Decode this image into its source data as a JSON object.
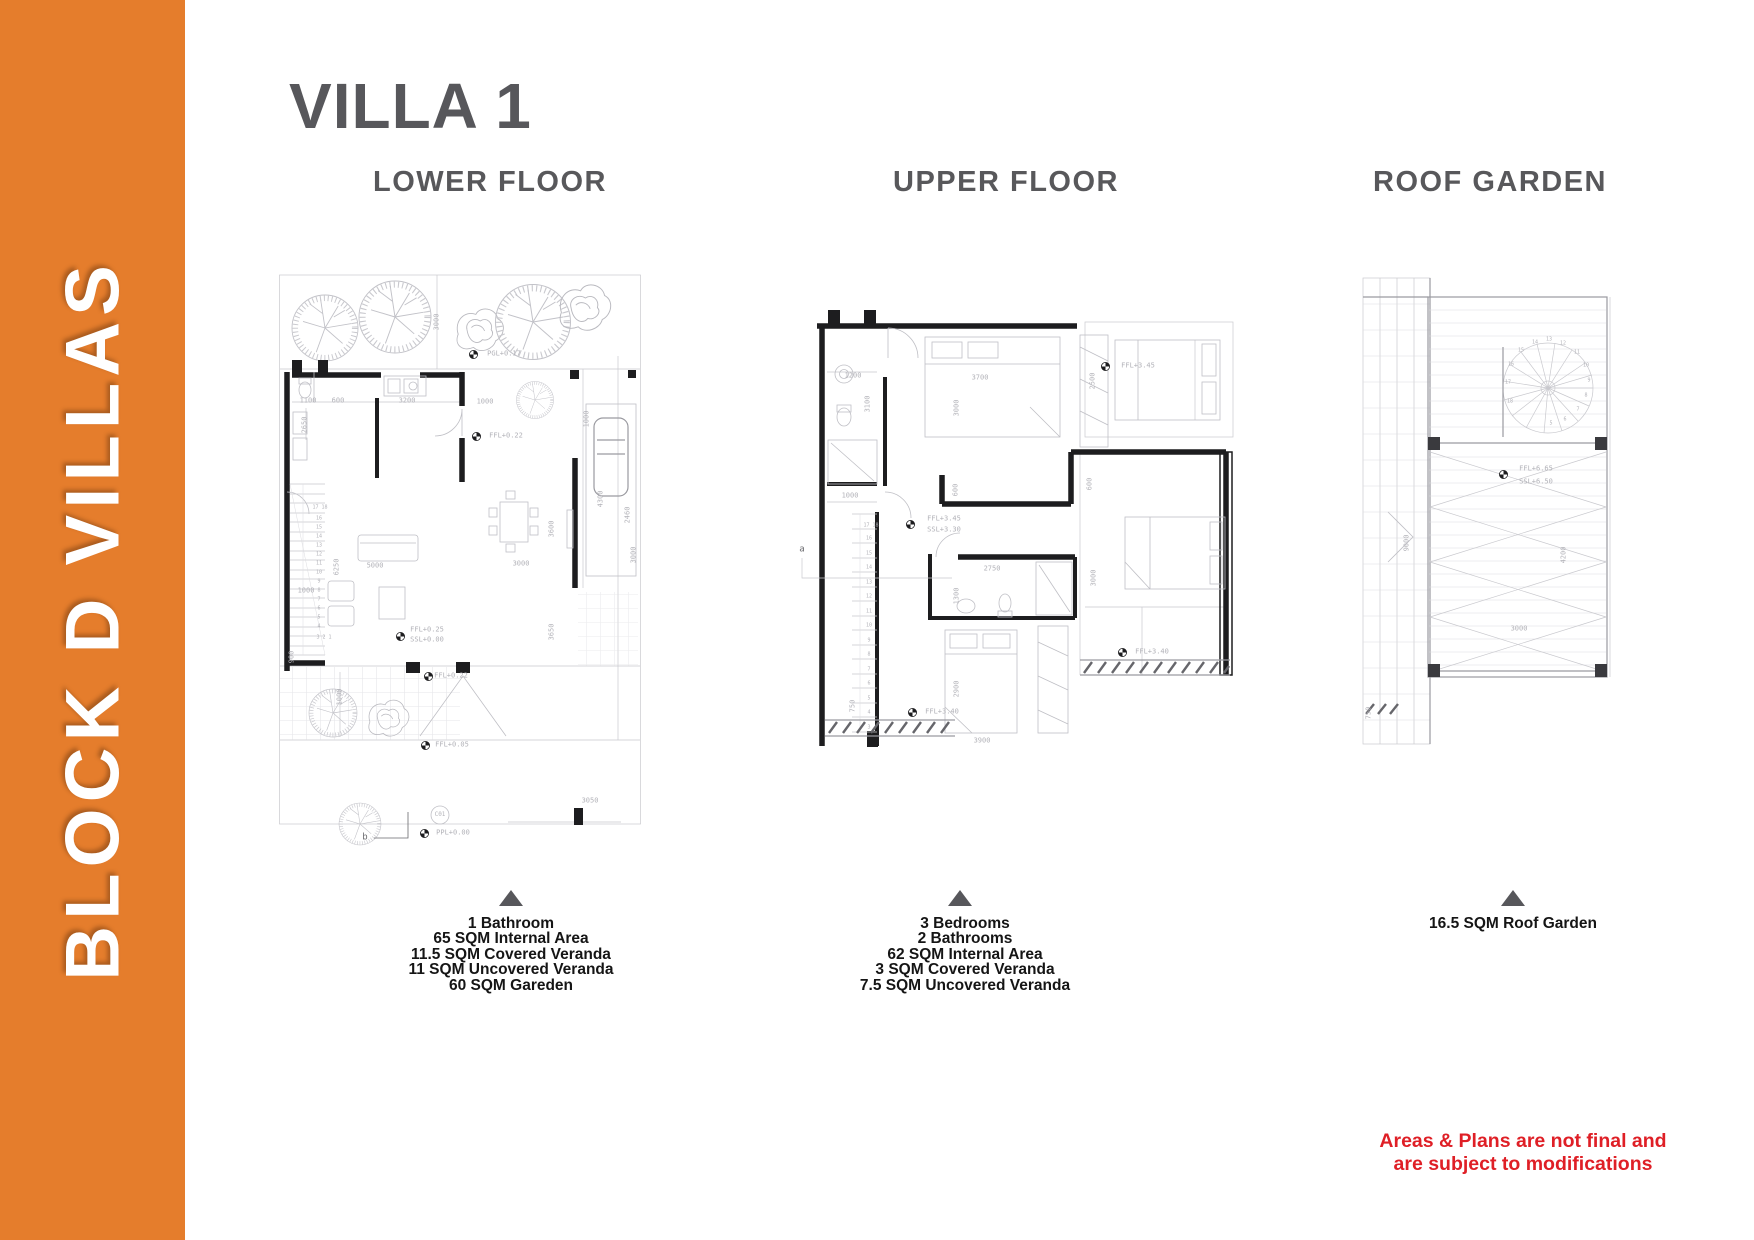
{
  "banner": {
    "text": "BLOCK D VILLAS",
    "bg_color": "#e57d2c",
    "text_color": "#ffffff"
  },
  "title": "VILLA 1",
  "sections": {
    "lower": {
      "heading": "LOWER FLOOR",
      "specs": [
        "1 Bathroom",
        "65 SQM Internal Area",
        "11.5 SQM Covered Veranda",
        "11 SQM Uncovered Veranda",
        "60 SQM Gareden"
      ]
    },
    "upper": {
      "heading": "UPPER FLOOR",
      "specs": [
        "3 Bedrooms",
        "2 Bathrooms",
        "62 SQM Internal Area",
        "3 SQM Covered Veranda",
        "7.5 SQM Uncovered Veranda"
      ]
    },
    "roof": {
      "heading": "ROOF GARDEN",
      "specs": [
        "16.5 SQM Roof Garden"
      ]
    }
  },
  "disclaimer": {
    "lines": [
      "Areas & Plans are not final and",
      "are subject to modifications"
    ],
    "color": "#df1f26"
  },
  "accent_gray": "#57575b",
  "annotations": {
    "lower": [
      {
        "t": "3000",
        "x": 159,
        "y": 50,
        "r": 1
      },
      {
        "t": "PGL+0.17",
        "x": 226,
        "y": 82
      },
      {
        "t": "1100",
        "x": 30,
        "y": 129
      },
      {
        "t": "600",
        "x": 60,
        "y": 129
      },
      {
        "t": "3200",
        "x": 129,
        "y": 129
      },
      {
        "t": "1000",
        "x": 207,
        "y": 130
      },
      {
        "t": "2650",
        "x": 27,
        "y": 153,
        "r": 1
      },
      {
        "t": "FFL+0.22",
        "x": 228,
        "y": 164
      },
      {
        "t": "1000",
        "x": 309,
        "y": 147,
        "r": 1
      },
      {
        "t": "4300",
        "x": 323,
        "y": 227,
        "r": 1
      },
      {
        "t": "2460",
        "x": 350,
        "y": 243,
        "r": 1
      },
      {
        "t": "3600",
        "x": 274,
        "y": 257,
        "r": 1
      },
      {
        "t": "3000",
        "x": 356,
        "y": 283,
        "r": 1
      },
      {
        "t": "5000",
        "x": 97,
        "y": 294
      },
      {
        "t": "3000",
        "x": 243,
        "y": 292
      },
      {
        "t": "6250",
        "x": 59,
        "y": 295,
        "r": 1
      },
      {
        "t": "1000",
        "x": 28,
        "y": 319
      },
      {
        "t": "3650",
        "x": 274,
        "y": 360,
        "r": 1
      },
      {
        "t": "900",
        "x": 14,
        "y": 385,
        "r": 1
      },
      {
        "t": "FFL+0.25",
        "x": 149,
        "y": 358
      },
      {
        "t": "SSL+0.00",
        "x": 149,
        "y": 368
      },
      {
        "t": "FFL+0.22",
        "x": 173,
        "y": 404
      },
      {
        "t": "1000",
        "x": 62,
        "y": 425,
        "r": 1
      },
      {
        "t": "3050",
        "x": 312,
        "y": 529
      },
      {
        "t": "FFL+0.05",
        "x": 174,
        "y": 473
      },
      {
        "t": "PPL+0.00",
        "x": 175,
        "y": 561
      },
      {
        "t": "C01",
        "x": 162,
        "y": 543,
        "s": 6
      },
      {
        "t": "b",
        "x": 87,
        "y": 566,
        "s": 9,
        "c": "#6a6a6e"
      },
      {
        "t": "17 18",
        "x": 42,
        "y": 236,
        "s": 5
      },
      {
        "t": "16",
        "x": 41,
        "y": 247,
        "s": 5
      },
      {
        "t": "15",
        "x": 41,
        "y": 256,
        "s": 5
      },
      {
        "t": "14",
        "x": 41,
        "y": 265,
        "s": 5
      },
      {
        "t": "13",
        "x": 41,
        "y": 274,
        "s": 5
      },
      {
        "t": "12",
        "x": 41,
        "y": 283,
        "s": 5
      },
      {
        "t": "11",
        "x": 41,
        "y": 292,
        "s": 5
      },
      {
        "t": "10",
        "x": 41,
        "y": 301,
        "s": 5
      },
      {
        "t": "9",
        "x": 41,
        "y": 310,
        "s": 5
      },
      {
        "t": "8",
        "x": 41,
        "y": 319,
        "s": 5
      },
      {
        "t": "7",
        "x": 41,
        "y": 328,
        "s": 5
      },
      {
        "t": "6",
        "x": 41,
        "y": 337,
        "s": 5
      },
      {
        "t": "5",
        "x": 41,
        "y": 346,
        "s": 5
      },
      {
        "t": "4",
        "x": 41,
        "y": 355,
        "s": 5
      },
      {
        "t": "3 2 1",
        "x": 46,
        "y": 366,
        "s": 5
      }
    ],
    "upper": [
      {
        "t": "1200",
        "x": 113,
        "y": 114
      },
      {
        "t": "3100",
        "x": 128,
        "y": 142,
        "r": 1
      },
      {
        "t": "3700",
        "x": 240,
        "y": 116
      },
      {
        "t": "3000",
        "x": 217,
        "y": 146,
        "r": 1
      },
      {
        "t": "2500",
        "x": 353,
        "y": 119,
        "r": 1
      },
      {
        "t": "FFL+3.45",
        "x": 398,
        "y": 104
      },
      {
        "t": "1000",
        "x": 110,
        "y": 234
      },
      {
        "t": "600",
        "x": 216,
        "y": 228,
        "r": 1
      },
      {
        "t": "600",
        "x": 350,
        "y": 222,
        "r": 1
      },
      {
        "t": "FFL+3.45",
        "x": 204,
        "y": 257
      },
      {
        "t": "SSL+3.30",
        "x": 204,
        "y": 268
      },
      {
        "t": "a",
        "x": 62,
        "y": 288,
        "s": 9,
        "c": "#6a6a6e"
      },
      {
        "t": "2750",
        "x": 252,
        "y": 307
      },
      {
        "t": "1300",
        "x": 217,
        "y": 334,
        "r": 1
      },
      {
        "t": "3000",
        "x": 354,
        "y": 316,
        "r": 1
      },
      {
        "t": "2900",
        "x": 217,
        "y": 427,
        "r": 1
      },
      {
        "t": "3900",
        "x": 242,
        "y": 479
      },
      {
        "t": "750",
        "x": 113,
        "y": 444,
        "r": 1
      },
      {
        "t": "FFL+3.40",
        "x": 202,
        "y": 450
      },
      {
        "t": "FFL+3.40",
        "x": 412,
        "y": 390
      },
      {
        "t": "17 18",
        "x": 131,
        "y": 264,
        "s": 5
      },
      {
        "t": "16",
        "x": 129,
        "y": 277,
        "s": 5
      },
      {
        "t": "15",
        "x": 129,
        "y": 292,
        "s": 5
      },
      {
        "t": "14",
        "x": 129,
        "y": 306,
        "s": 5
      },
      {
        "t": "13",
        "x": 129,
        "y": 321,
        "s": 5
      },
      {
        "t": "12",
        "x": 129,
        "y": 335,
        "s": 5
      },
      {
        "t": "11",
        "x": 129,
        "y": 350,
        "s": 5
      },
      {
        "t": "10",
        "x": 129,
        "y": 364,
        "s": 5
      },
      {
        "t": "9",
        "x": 129,
        "y": 379,
        "s": 5
      },
      {
        "t": "8",
        "x": 129,
        "y": 393,
        "s": 5
      },
      {
        "t": "7",
        "x": 129,
        "y": 408,
        "s": 5
      },
      {
        "t": "6",
        "x": 129,
        "y": 422,
        "s": 5
      },
      {
        "t": "5",
        "x": 129,
        "y": 437,
        "s": 5
      },
      {
        "t": "4",
        "x": 129,
        "y": 451,
        "s": 5
      },
      {
        "t": "3",
        "x": 129,
        "y": 466,
        "s": 5
      }
    ],
    "roof": [
      {
        "t": "FFL+6.65",
        "x": 178,
        "y": 207
      },
      {
        "t": "SSL+6.50",
        "x": 178,
        "y": 220
      },
      {
        "t": "9000",
        "x": 49,
        "y": 281,
        "r": 1
      },
      {
        "t": "4200",
        "x": 206,
        "y": 293,
        "r": 1
      },
      {
        "t": "3000",
        "x": 161,
        "y": 367
      },
      {
        "t": "750",
        "x": 11,
        "y": 451,
        "r": 1
      },
      {
        "t": "18",
        "x": 152,
        "y": 140,
        "s": 5
      },
      {
        "t": "17",
        "x": 150,
        "y": 121,
        "s": 5
      },
      {
        "t": "16",
        "x": 153,
        "y": 103,
        "s": 5
      },
      {
        "t": "15",
        "x": 163,
        "y": 89,
        "s": 5
      },
      {
        "t": "14",
        "x": 177,
        "y": 81,
        "s": 5
      },
      {
        "t": "13",
        "x": 191,
        "y": 78,
        "s": 5
      },
      {
        "t": "12",
        "x": 205,
        "y": 82,
        "s": 5
      },
      {
        "t": "11",
        "x": 219,
        "y": 91,
        "s": 5
      },
      {
        "t": "10",
        "x": 228,
        "y": 104,
        "s": 5
      },
      {
        "t": "9",
        "x": 231,
        "y": 119,
        "s": 5
      },
      {
        "t": "8",
        "x": 228,
        "y": 134,
        "s": 5
      },
      {
        "t": "7",
        "x": 220,
        "y": 148,
        "s": 5
      },
      {
        "t": "6",
        "x": 207,
        "y": 158,
        "s": 5
      },
      {
        "t": "5",
        "x": 193,
        "y": 162,
        "s": 5
      }
    ]
  }
}
